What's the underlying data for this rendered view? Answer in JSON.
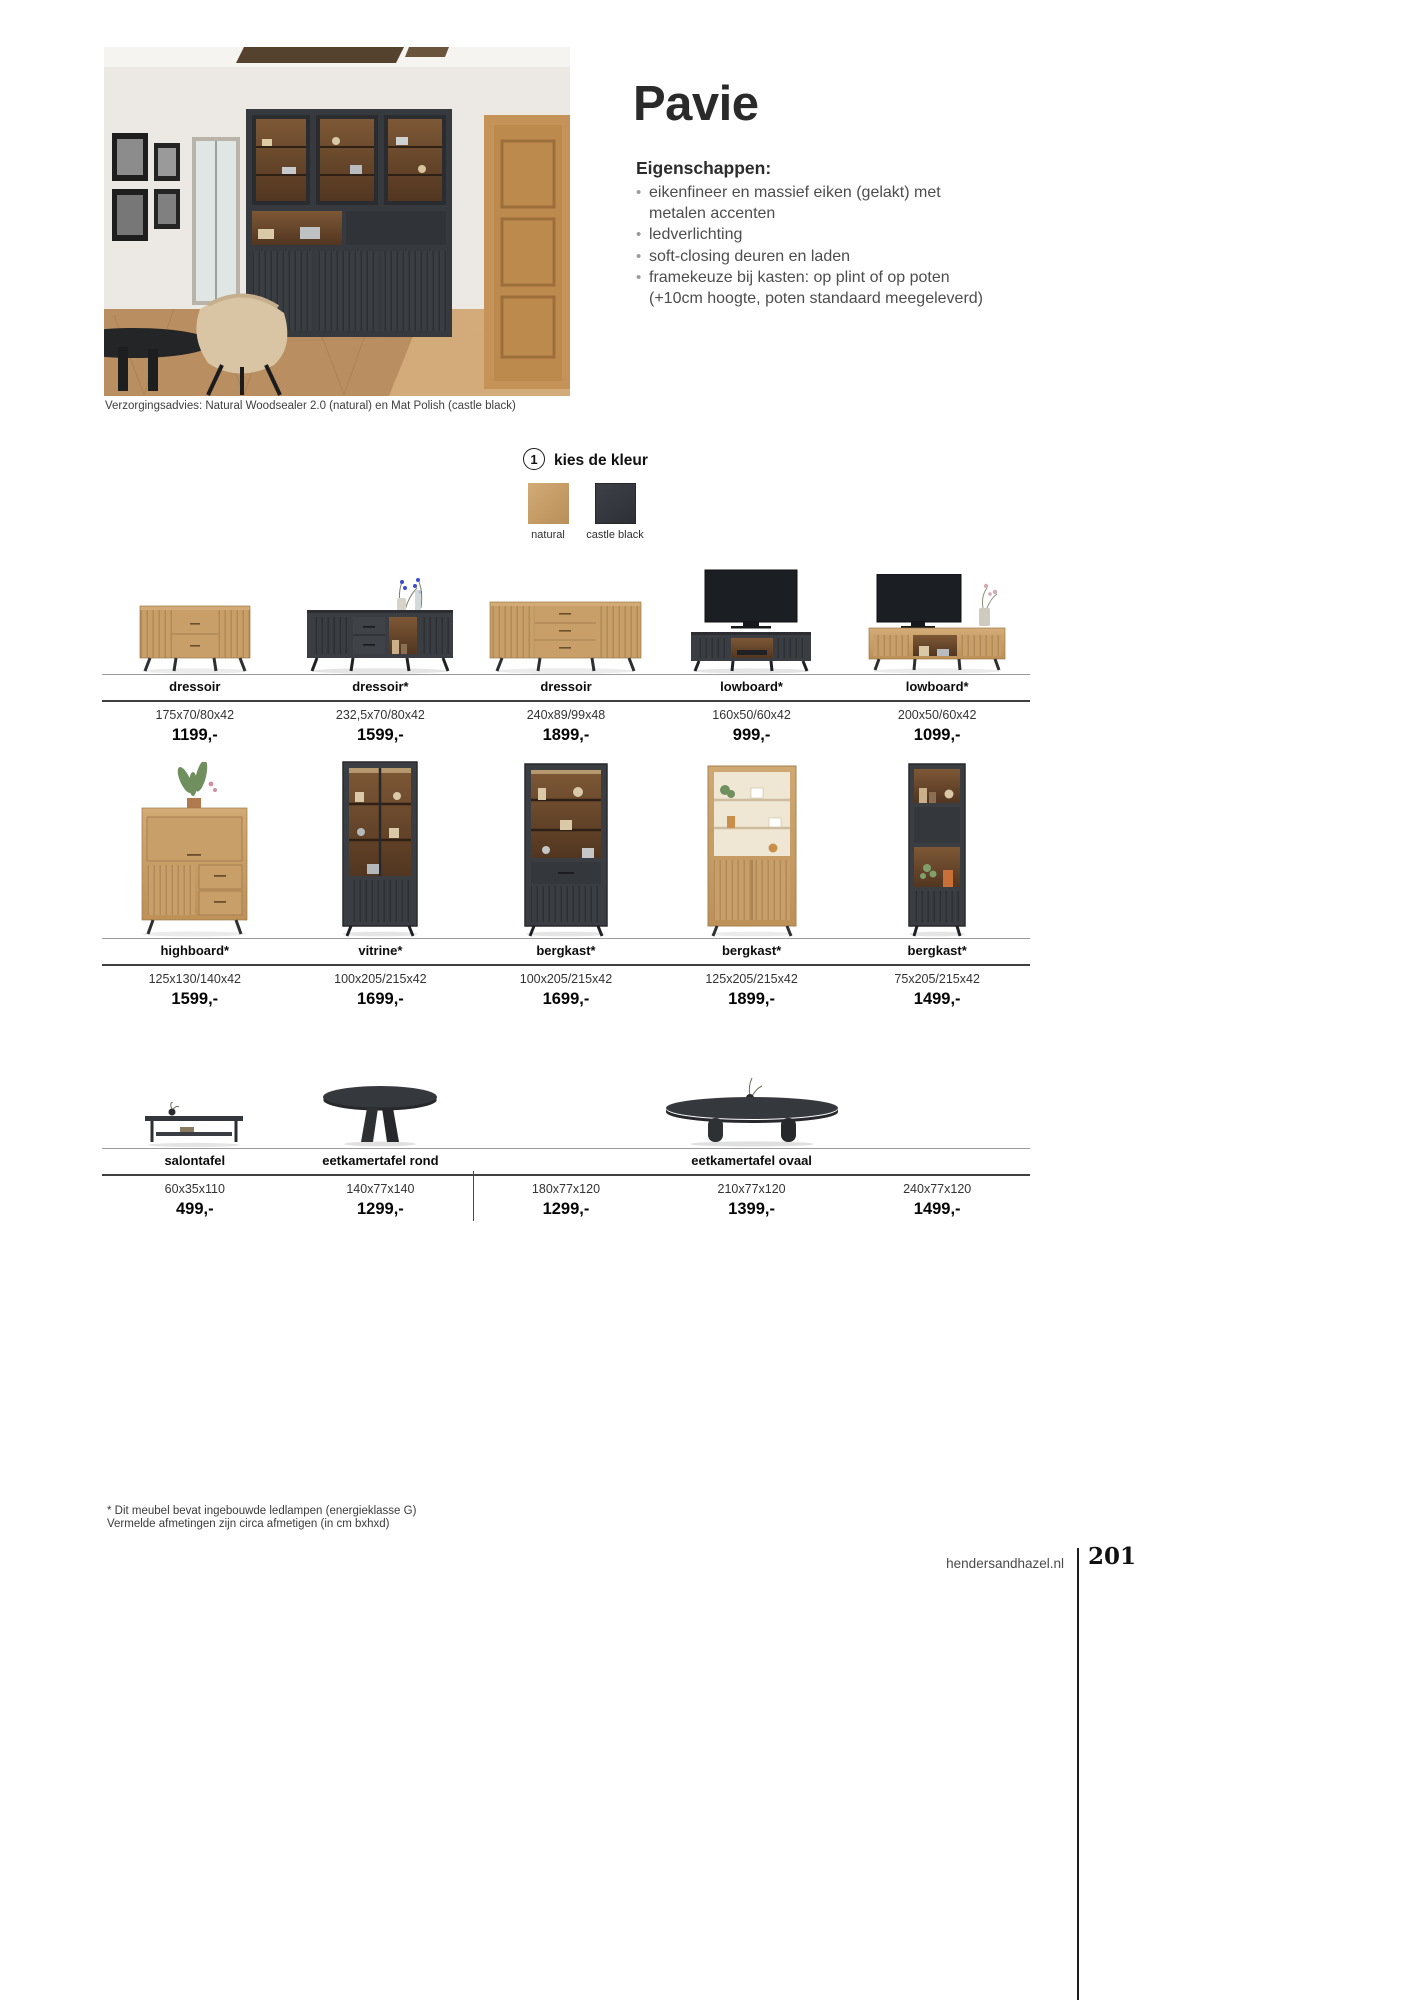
{
  "header": {
    "title": "Pavie",
    "features_heading": "Eigenschappen:",
    "features": [
      "eikenfineer en massief eiken (gelakt) met\nmetalen accenten",
      "ledverlichting",
      "soft-closing deuren en laden",
      "framekeuze bij kasten: op plint of op poten\n(+10cm hoogte, poten standaard meegeleverd)"
    ],
    "photo_caption": "Verzorgingsadvies: Natural Woodsealer 2.0 (natural) en Mat Polish (castle black)"
  },
  "color_step": {
    "number": "1",
    "label": "kies de kleur",
    "options": [
      {
        "name": "natural",
        "color": "#c79e68"
      },
      {
        "name": "castle black",
        "color": "#34373d"
      }
    ]
  },
  "products": {
    "row1": [
      {
        "name": "dressoir",
        "dims": "175x70/80x42",
        "price": "1199,-"
      },
      {
        "name": "dressoir*",
        "dims": "232,5x70/80x42",
        "price": "1599,-"
      },
      {
        "name": "dressoir",
        "dims": "240x89/99x48",
        "price": "1899,-"
      },
      {
        "name": "lowboard*",
        "dims": "160x50/60x42",
        "price": "999,-"
      },
      {
        "name": "lowboard*",
        "dims": "200x50/60x42",
        "price": "1099,-"
      }
    ],
    "row2": [
      {
        "name": "highboard*",
        "dims": "125x130/140x42",
        "price": "1599,-"
      },
      {
        "name": "vitrine*",
        "dims": "100x205/215x42",
        "price": "1699,-"
      },
      {
        "name": "bergkast*",
        "dims": "100x205/215x42",
        "price": "1699,-"
      },
      {
        "name": "bergkast*",
        "dims": "125x205/215x42",
        "price": "1899,-"
      },
      {
        "name": "bergkast*",
        "dims": "75x205/215x42",
        "price": "1499,-"
      }
    ],
    "row3_group_labels": [
      "salontafel",
      "eetkamertafel rond",
      "eetkamertafel ovaal"
    ],
    "row3": [
      {
        "dims": "60x35x110",
        "price": "499,-"
      },
      {
        "dims": "140x77x140",
        "price": "1299,-"
      },
      {
        "dims": "180x77x120",
        "price": "1299,-"
      },
      {
        "dims": "210x77x120",
        "price": "1399,-"
      },
      {
        "dims": "240x77x120",
        "price": "1499,-"
      }
    ]
  },
  "footnotes": [
    "* Dit meubel bevat ingebouwde ledlampen (energieklasse G)",
    "Vermelde afmetingen zijn circa afmetigen (in cm bxhxd)"
  ],
  "footer": {
    "website": "hendersandhazel.nl",
    "page_number": "201"
  }
}
